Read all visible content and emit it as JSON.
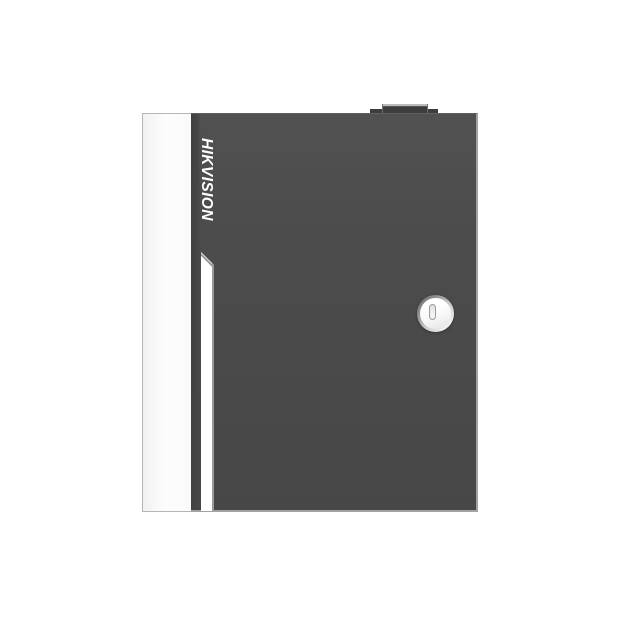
{
  "product": {
    "brand_logo": "HIKVISION"
  },
  "icons": {
    "keyhole": "keyhole-icon"
  },
  "colors": {
    "background": "#ffffff",
    "door_front": "#4c4c4c",
    "door_edge_highlight": "#a2a2a2",
    "side_panel": "#fafafa",
    "side_panel_border": "#b5b5b5",
    "brand_text": "#ffffff",
    "accent_stripe": "#ffffff",
    "stripe_edge": "#9a9a9a",
    "lock_ring": "#8a8a8a",
    "lock_face": "#f7f7f7",
    "keyhole_outline": "#9b9b9b",
    "top_tab": "#3d3d3d",
    "top_tab_highlight": "#bcbcbc"
  }
}
